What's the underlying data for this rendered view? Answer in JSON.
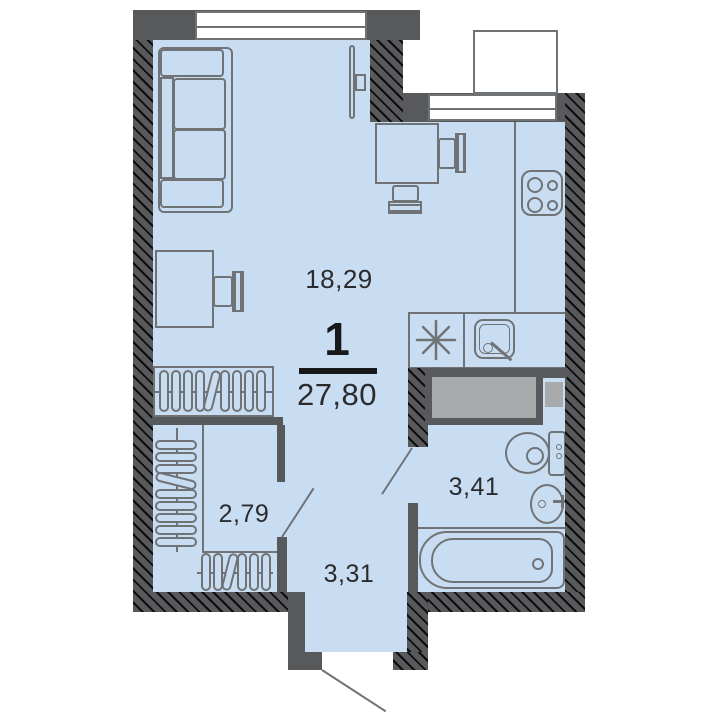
{
  "summary": {
    "rooms_count": "1",
    "total_area": "27,80"
  },
  "rooms": {
    "living": {
      "area_label": "18,29"
    },
    "closet": {
      "area_label": "2,79"
    },
    "hallway": {
      "area_label": "3,31"
    },
    "bathroom": {
      "area_label": "3,41"
    }
  },
  "furniture_icons": [
    "sofa",
    "tv",
    "dining-table",
    "dining-chair",
    "desk",
    "desk-chair",
    "wardrobe-hangers",
    "stove",
    "fridge-star",
    "kitchen-sink",
    "duct-shaft",
    "toilet",
    "washbasin",
    "bathtub",
    "window",
    "balcony",
    "entry-door-swing",
    "interior-door-swing"
  ],
  "colors": {
    "floor": "#c9ddf2",
    "wall": "#58595b",
    "line": "#707376",
    "duct": "#a8aaac",
    "text": "#2b2b2d",
    "ink": "#17181a",
    "bg": "#ffffff"
  }
}
